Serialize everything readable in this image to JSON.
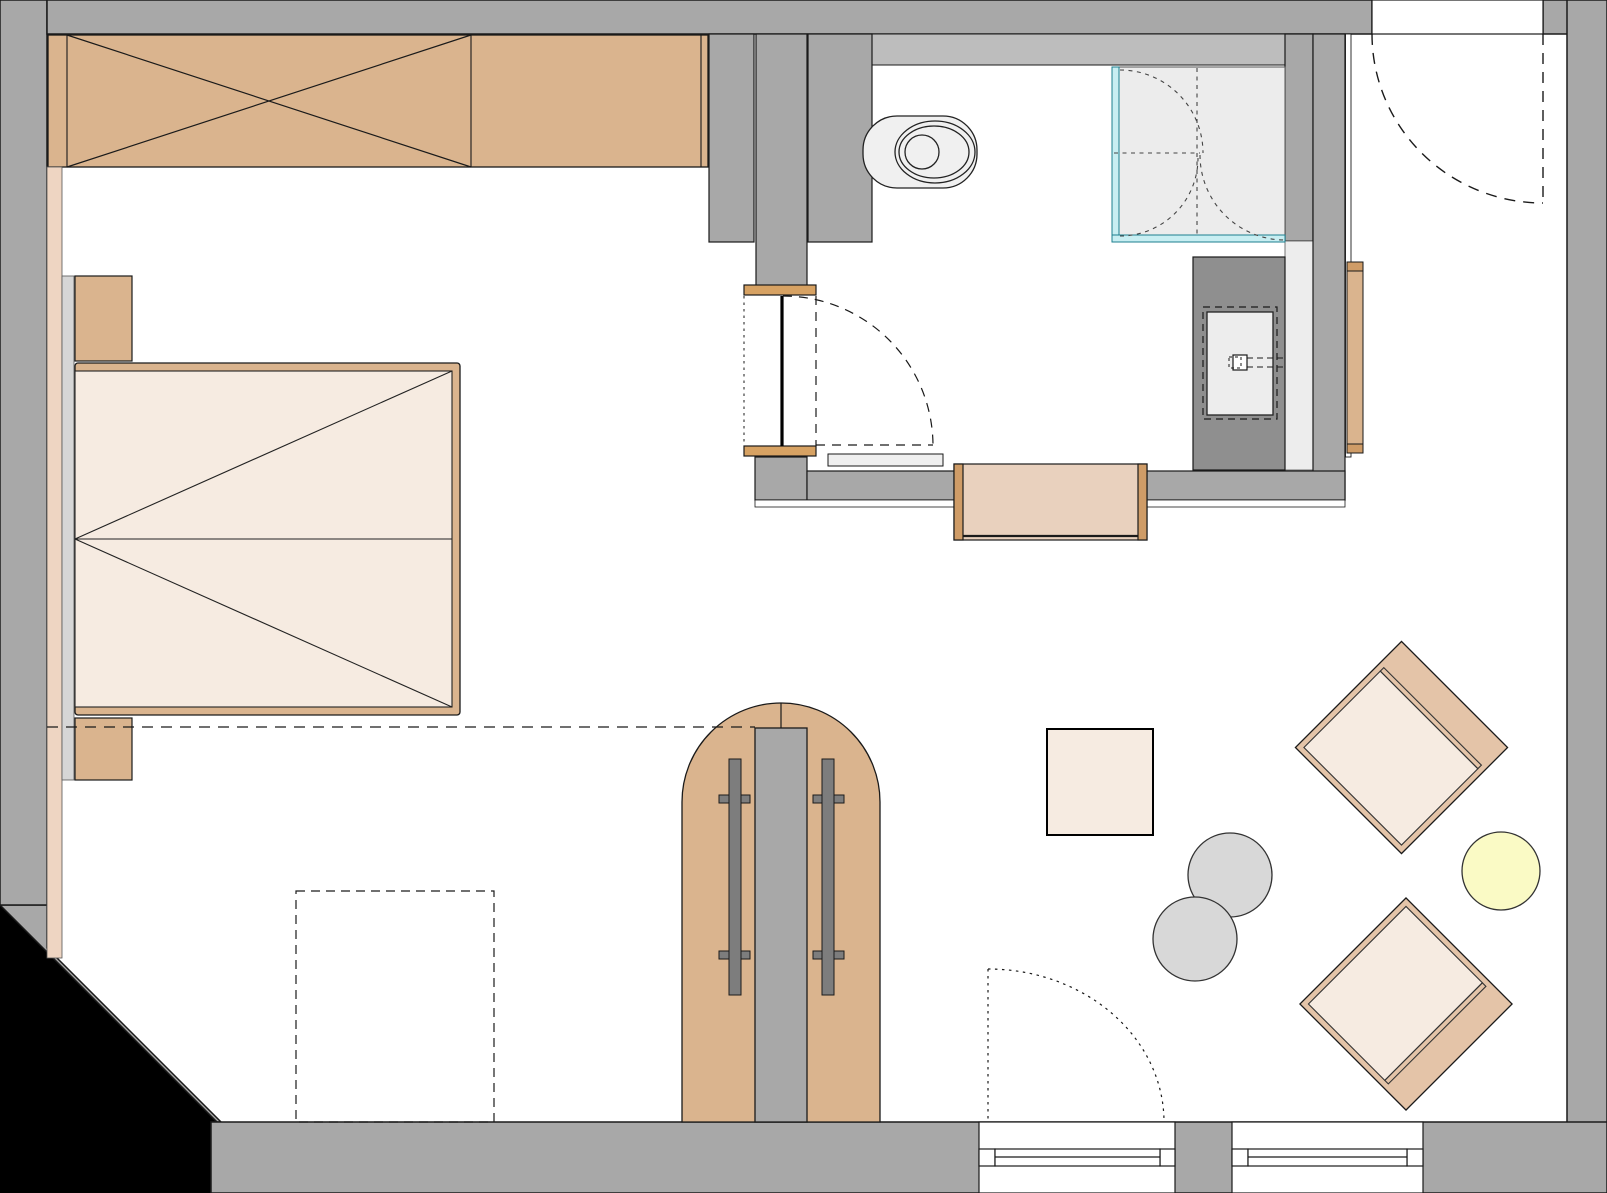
{
  "canvas": {
    "width": 1607,
    "height": 1193
  },
  "colors": {
    "floor": "#ffffff",
    "outside": "#000000",
    "wall": "#a8a8a8",
    "wall_light": "#bdbdbd",
    "wall_dark": "#8f8f8f",
    "bar_gray": "#7d7d7d",
    "wood": "#dab48e",
    "wood_dark": "#cf9c67",
    "lintel": "#d7a263",
    "bench": "#e9d1be",
    "cream": "#f6ebe1",
    "chair_band": "#e4c4a8",
    "pink_strip": "#eed5c2",
    "ledge": "#d6d6d6",
    "mat": "#efefef",
    "shower_floor": "#ececec",
    "niche": "#ededed",
    "glass_fill": "#c8eef2",
    "glass_stroke": "#1d7f8f",
    "stool": "#d8d8d8",
    "lamp": "#fafac5",
    "line": "#1a1a1a"
  },
  "fixtures": {
    "wardrobe": "wardrobe",
    "bed": "double-bed",
    "nightstand": "nightstand",
    "toilet": "wall-hung-toilet",
    "shower": "shower-enclosure",
    "vanity": "vanity-with-sink",
    "bench": "bench",
    "radiator": "radiator-panel",
    "arch_door": "arched-double-door",
    "armchair": "armchair",
    "stool": "stool",
    "lamp": "floor-lamp",
    "table": "side-table",
    "window": "window",
    "door": "door-swing"
  }
}
